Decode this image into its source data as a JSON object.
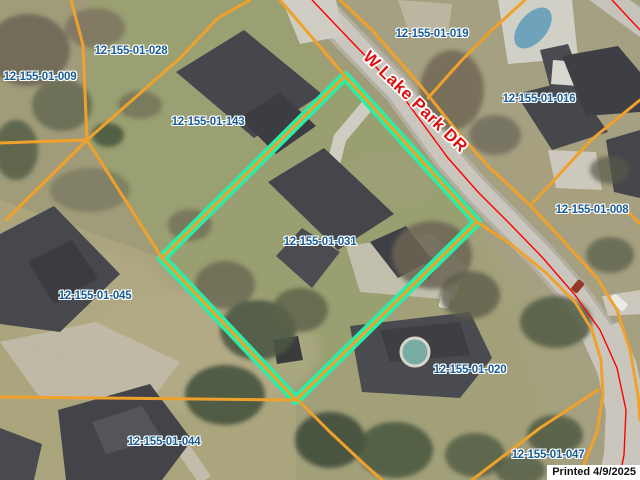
{
  "map": {
    "street_label": "W Lake Park DR",
    "printed_label": "Printed 4/9/2025",
    "highlighted_parcel": "12-155-01-031",
    "parcels": [
      {
        "id": "12-155-01-009"
      },
      {
        "id": "12-155-01-028"
      },
      {
        "id": "12-155-01-019"
      },
      {
        "id": "12-155-01-016"
      },
      {
        "id": "12-155-01-143"
      },
      {
        "id": "12-155-01-008"
      },
      {
        "id": "12-155-01-031"
      },
      {
        "id": "12-155-01-045"
      },
      {
        "id": "12-155-01-020"
      },
      {
        "id": "12-155-01-044"
      },
      {
        "id": "12-155-01-047"
      }
    ]
  },
  "colors": {
    "parcel_line": "#f0a12c",
    "highlight": "#2ceda6",
    "centerline": "#ff0000",
    "label_blue": "#1c5d91",
    "street_red": "#de1212",
    "printed_black": "#111111"
  }
}
